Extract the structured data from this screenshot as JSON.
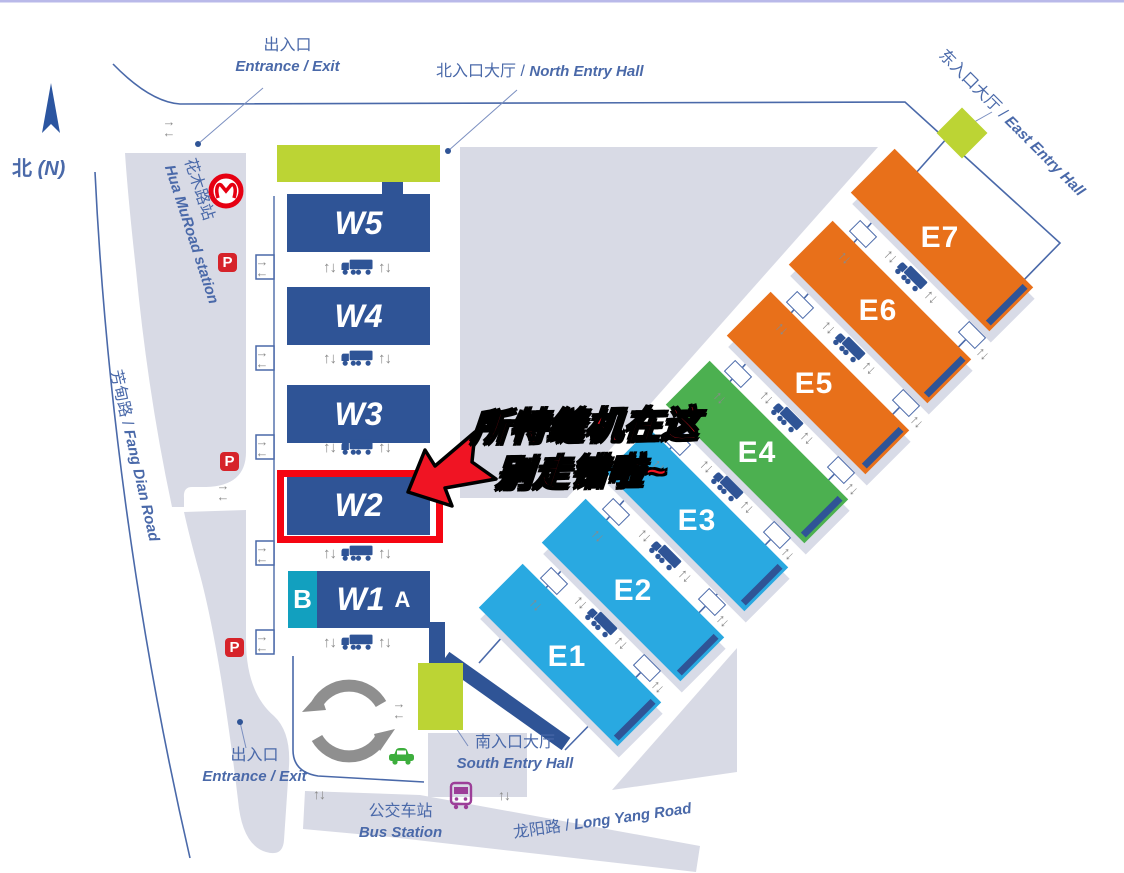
{
  "compass": {
    "zh": "北",
    "en": "(N)"
  },
  "gates": {
    "north": {
      "zh": "出入口",
      "en": "Entrance / Exit"
    },
    "south": {
      "zh": "出入口",
      "en": "Entrance / Exit"
    }
  },
  "entry_halls": {
    "north": {
      "zh": "北入口大厅",
      "sep": " / ",
      "en": "North Entry Hall"
    },
    "east": {
      "zh": "东入口大厅",
      "sep": " / ",
      "en": "East Entry Hall"
    },
    "south": {
      "zh": "南入口大厅",
      "en": "South Entry Hall"
    }
  },
  "stations": {
    "metro": {
      "zh": "花木路站",
      "en": "Hua MuRoad station"
    },
    "bus": {
      "zh": "公交车站",
      "en": "Bus Station"
    }
  },
  "roads": {
    "fang_dian": {
      "zh": "芳甸路",
      "sep": " / ",
      "en": "Fang Dian Road"
    },
    "long_yang": {
      "zh": "龙阳路",
      "sep": " / ",
      "en": "Long Yang Road"
    }
  },
  "halls": {
    "west": [
      {
        "id": "W5"
      },
      {
        "id": "W4"
      },
      {
        "id": "W3"
      },
      {
        "id": "W2"
      },
      {
        "id": "W1",
        "wing_left": "B",
        "wing_right": "A"
      }
    ],
    "east": [
      {
        "id": "E1",
        "color": "#29A9E1"
      },
      {
        "id": "E2",
        "color": "#29A9E1"
      },
      {
        "id": "E3",
        "color": "#29A9E1"
      },
      {
        "id": "E4",
        "color": "#4CB050"
      },
      {
        "id": "E5",
        "color": "#E8701A"
      },
      {
        "id": "E6",
        "color": "#E8701A"
      },
      {
        "id": "E7",
        "color": "#E8701A"
      }
    ]
  },
  "annotation": {
    "line1": "所特缝机在这",
    "line2": "别走错啦~"
  },
  "icons": {
    "parking": "P",
    "up_down": "↑↓",
    "right": "→",
    "left": "←"
  },
  "colors": {
    "hall_navy": "#2F5496",
    "hall_blue": "#29A9E1",
    "hall_green": "#4CB050",
    "hall_orange": "#E8701A",
    "entry_green": "#BCD434",
    "wing_teal": "#12A0BF",
    "highlight_red": "#F50512",
    "map_gray": "#D8DAE5",
    "line_blue": "#4A69A9",
    "metro_red": "#E60012",
    "parking_red": "#D6232A",
    "bus_purple": "#9C3E98",
    "car_green": "#3DAE3D"
  }
}
